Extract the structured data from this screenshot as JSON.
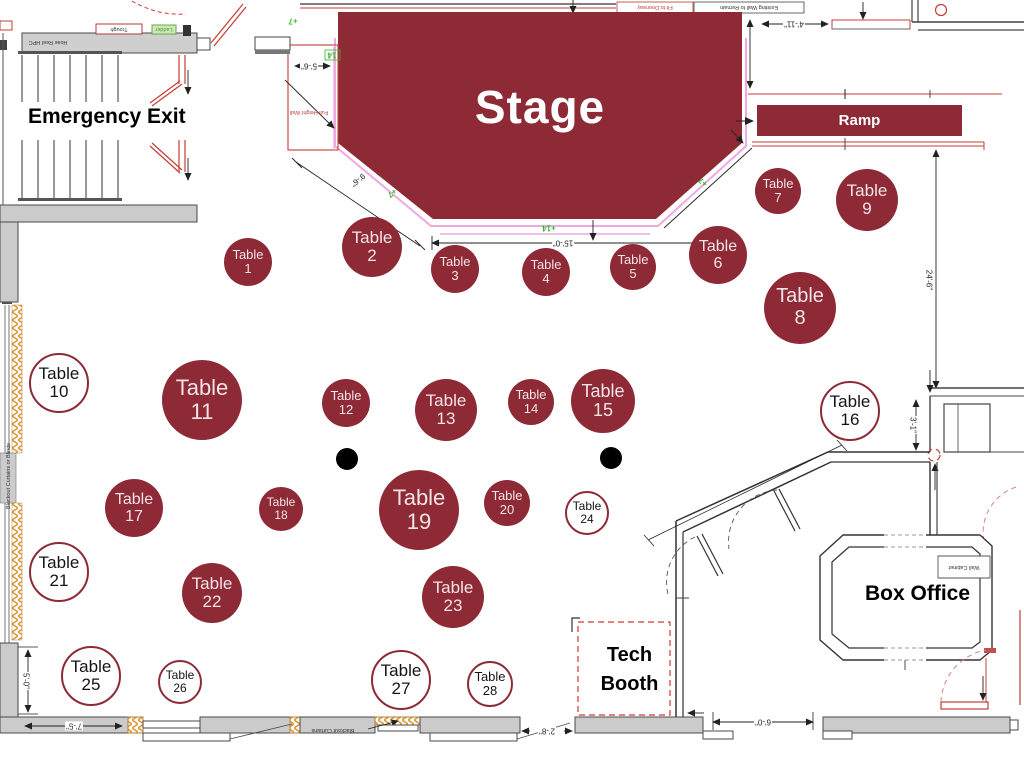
{
  "title": "Venue floor plan seating chart",
  "colors": {
    "table_fill": "#8d2a36",
    "table_text": "#f4e3e6",
    "outline_table_border": "#8d2a36",
    "stage_fill": "#8d2a36",
    "stage_outline_pink": "#eeaade",
    "cad_red": "#c43c35",
    "cad_green": "#2eb82e",
    "wall_gray": "#cbcbcb",
    "hatch_orange": "#dd9a3f"
  },
  "labels": {
    "stage": "Stage",
    "ramp": "Ramp",
    "emergency_exit": "Emergency Exit",
    "box_office": "Box Office",
    "tech_booth_line1": "Tech",
    "tech_booth_line2": "Booth",
    "table_word": "Table"
  },
  "tables": [
    {
      "n": "1",
      "x": 248,
      "y": 262,
      "r": 24,
      "filled": true
    },
    {
      "n": "2",
      "x": 372,
      "y": 247,
      "r": 30,
      "filled": true
    },
    {
      "n": "3",
      "x": 455,
      "y": 269,
      "r": 24,
      "filled": true
    },
    {
      "n": "4",
      "x": 546,
      "y": 272,
      "r": 24,
      "filled": true
    },
    {
      "n": "5",
      "x": 633,
      "y": 267,
      "r": 23,
      "filled": true
    },
    {
      "n": "6",
      "x": 718,
      "y": 255,
      "r": 29,
      "filled": true
    },
    {
      "n": "7",
      "x": 778,
      "y": 191,
      "r": 23,
      "filled": true
    },
    {
      "n": "8",
      "x": 800,
      "y": 308,
      "r": 36,
      "filled": true
    },
    {
      "n": "9",
      "x": 867,
      "y": 200,
      "r": 31,
      "filled": true
    },
    {
      "n": "10",
      "x": 59,
      "y": 383,
      "r": 30,
      "filled": false
    },
    {
      "n": "11",
      "x": 202,
      "y": 400,
      "r": 40,
      "filled": true
    },
    {
      "n": "12",
      "x": 346,
      "y": 403,
      "r": 24,
      "filled": true
    },
    {
      "n": "13",
      "x": 446,
      "y": 410,
      "r": 31,
      "filled": true
    },
    {
      "n": "14",
      "x": 531,
      "y": 402,
      "r": 23,
      "filled": true
    },
    {
      "n": "15",
      "x": 603,
      "y": 401,
      "r": 32,
      "filled": true
    },
    {
      "n": "16",
      "x": 850,
      "y": 411,
      "r": 30,
      "filled": false
    },
    {
      "n": "17",
      "x": 134,
      "y": 508,
      "r": 29,
      "filled": true
    },
    {
      "n": "18",
      "x": 281,
      "y": 509,
      "r": 22,
      "filled": true
    },
    {
      "n": "19",
      "x": 419,
      "y": 510,
      "r": 40,
      "filled": true
    },
    {
      "n": "20",
      "x": 507,
      "y": 503,
      "r": 23,
      "filled": true
    },
    {
      "n": "21",
      "x": 59,
      "y": 572,
      "r": 30,
      "filled": false
    },
    {
      "n": "22",
      "x": 212,
      "y": 593,
      "r": 30,
      "filled": true
    },
    {
      "n": "23",
      "x": 453,
      "y": 597,
      "r": 31,
      "filled": true
    },
    {
      "n": "24",
      "x": 587,
      "y": 513,
      "r": 22,
      "filled": false
    },
    {
      "n": "25",
      "x": 91,
      "y": 676,
      "r": 30,
      "filled": false
    },
    {
      "n": "26",
      "x": 180,
      "y": 682,
      "r": 22,
      "filled": false
    },
    {
      "n": "27",
      "x": 401,
      "y": 680,
      "r": 30,
      "filled": false
    },
    {
      "n": "28",
      "x": 490,
      "y": 684,
      "r": 23,
      "filled": false
    }
  ],
  "dots": [
    {
      "x": 347,
      "y": 459
    },
    {
      "x": 611,
      "y": 458
    }
  ],
  "dim_labels": [
    {
      "text": "5'-6\"",
      "x": 309,
      "y": 66,
      "rot": 180
    },
    {
      "text": "9'-6\"",
      "x": 358,
      "y": 180,
      "rot": 140
    },
    {
      "text": "15'-0\"",
      "x": 563,
      "y": 243,
      "rot": 180
    },
    {
      "text": "4'-11\"",
      "x": 794,
      "y": 24,
      "rot": 180
    },
    {
      "text": "24'-6\"",
      "x": 929,
      "y": 280,
      "rot": 90
    },
    {
      "text": "3'-1\"",
      "x": 913,
      "y": 425,
      "rot": 90
    },
    {
      "text": "7'-5\"",
      "x": 74,
      "y": 726,
      "rot": 180
    },
    {
      "text": "5'-0\"",
      "x": 26,
      "y": 681,
      "rot": 90
    },
    {
      "text": "2'-8\"",
      "x": 547,
      "y": 731,
      "rot": 180
    },
    {
      "text": "6'-0\"",
      "x": 763,
      "y": 722,
      "rot": 180
    },
    {
      "text": "+7",
      "x": 293,
      "y": 21,
      "rot": 180,
      "green": true
    },
    {
      "text": "14",
      "x": 332,
      "y": 55,
      "rot": 180,
      "green": true
    },
    {
      "text": "+7",
      "x": 392,
      "y": 193,
      "rot": 140,
      "green": true
    },
    {
      "text": "+7",
      "x": 703,
      "y": 182,
      "rot": -140,
      "green": true
    },
    {
      "text": "+14",
      "x": 549,
      "y": 228,
      "rot": 180,
      "green": true
    }
  ],
  "tiny_labels": [
    {
      "text": "Trough",
      "x": 119,
      "y": 29,
      "rot": 180,
      "c": "dark"
    },
    {
      "text": "Ladder",
      "x": 164,
      "y": 29,
      "rot": 180,
      "c": "green"
    },
    {
      "text": "Hose Reel HPC",
      "x": 48,
      "y": 42,
      "rot": 180,
      "c": "dark"
    },
    {
      "text": "Fit to Doorway",
      "x": 655,
      "y": 7,
      "rot": 180,
      "c": "red"
    },
    {
      "text": "Existing Wall to Remain",
      "x": 749,
      "y": 7,
      "rot": 180,
      "c": "dark"
    },
    {
      "text": "Full Height Wall",
      "x": 309,
      "y": 112,
      "rot": 180,
      "c": "red"
    },
    {
      "text": "Wall Cabinet",
      "x": 964,
      "y": 567,
      "rot": 180,
      "c": "dark"
    },
    {
      "text": "Blackout Curtains",
      "x": 333,
      "y": 730,
      "rot": 180,
      "c": "dark"
    },
    {
      "text": "Blackout Curtains or Blinds",
      "x": 9,
      "y": 476,
      "rot": -90,
      "c": "dark"
    }
  ]
}
